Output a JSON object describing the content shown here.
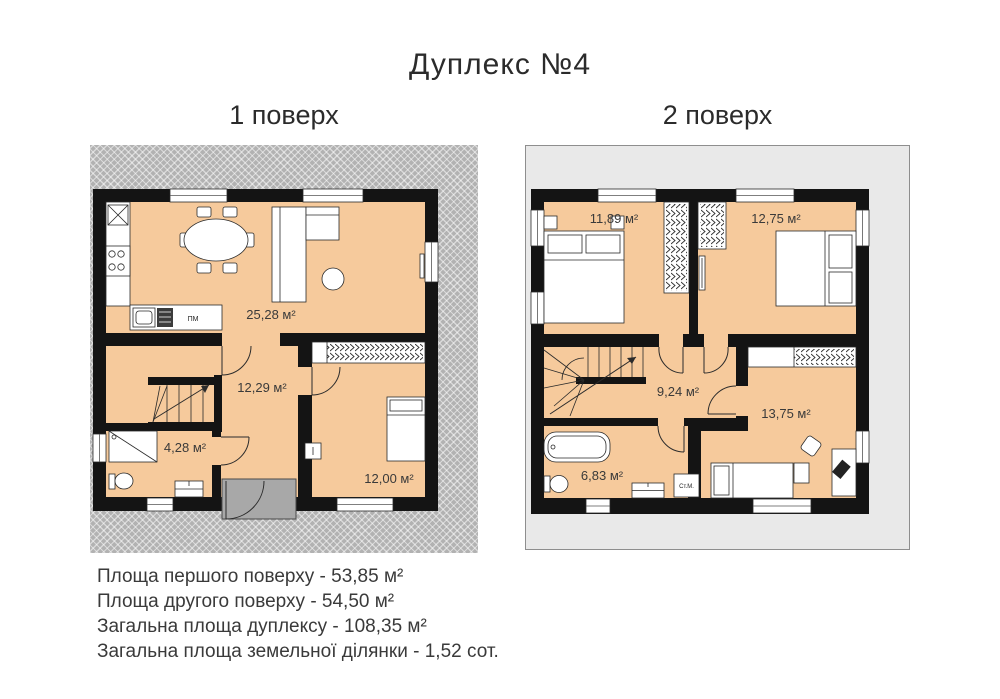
{
  "title": "Дуплекс №4",
  "floor1": {
    "label": "1 поверх",
    "rooms": {
      "living": "25,28 м²",
      "hall": "12,29 м²",
      "bathroom": "4,28 м²",
      "bedroom": "12,00 м²"
    },
    "labels": {
      "dishwasher": "ПМ"
    }
  },
  "floor2": {
    "label": "2 поверх",
    "rooms": {
      "bedroom_left": "11,89 м²",
      "bedroom_right": "12,75 м²",
      "hall": "9,24 м²",
      "bedroom_small": "13,75 м²",
      "bathroom": "6,83 м²"
    },
    "labels": {
      "washing_machine": "Ст.М."
    }
  },
  "summary": [
    "Площа першого поверху - 53,85 м²",
    "Площа другого поверху - 54,50 м²",
    "Загальна площа дуплексу - 108,35 м²",
    "Загальна площа земельної ділянки - 1,52 сот."
  ],
  "colors": {
    "room_fill": "#f6ca9c",
    "wall": "#141414",
    "site_hatch_bg": "#b2b2b2",
    "floor2_bg": "#e9e9e9",
    "porch": "#a8a8a8"
  }
}
